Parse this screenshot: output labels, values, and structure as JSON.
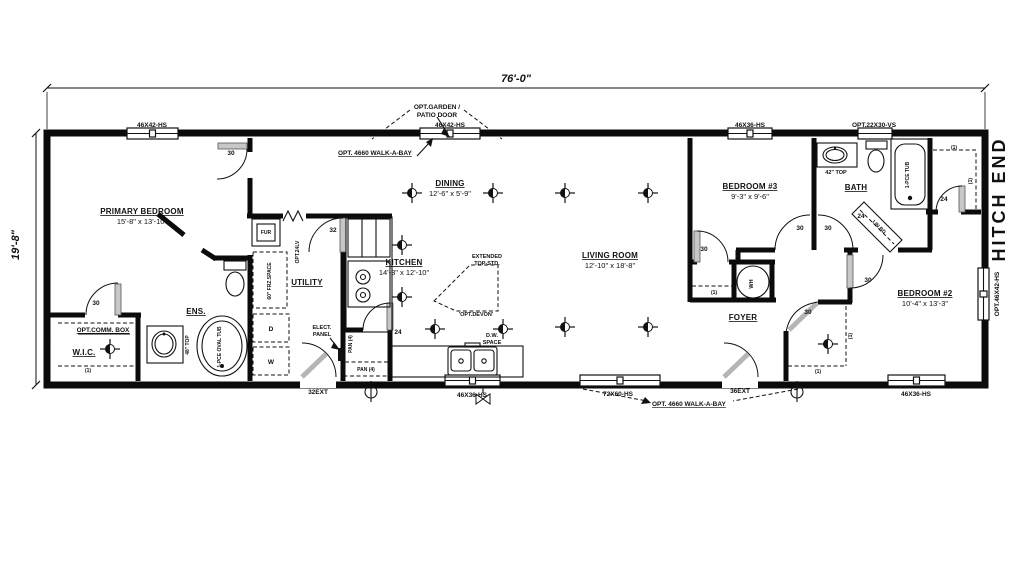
{
  "plan": {
    "hitch_end": "HITCH END"
  },
  "dimensions": {
    "overall_width": "76'-0\"",
    "overall_depth": "19'-8\""
  },
  "rooms": {
    "primary_bedroom": {
      "name": "PRIMARY BEDROOM",
      "size": "15'-8\" x 13'-10\""
    },
    "dining": {
      "name": "DINING",
      "size": "12'-6\" x 5'-9\""
    },
    "kitchen": {
      "name": "KITCHEN",
      "size": "14'-3\" x 12'-10\""
    },
    "living_room": {
      "name": "LIVING ROOM",
      "size": "12'-10\" x 18'-8\""
    },
    "bedroom_3": {
      "name": "BEDROOM #3",
      "size": "9'-3\" x 9'-6\""
    },
    "bedroom_2": {
      "name": "BEDROOM #2",
      "size": "10'-4\" x 13'-3\""
    },
    "bath": {
      "name": "BATH"
    },
    "utility": {
      "name": "UTILITY"
    },
    "foyer": {
      "name": "FOYER"
    },
    "ensuite": {
      "name": "ENS."
    },
    "walk_in_closet": {
      "name": "W.I.C."
    }
  },
  "windows": {
    "primary_top": "46X42-HS",
    "dining_top": "46X42-HS",
    "bedroom3_top": "46X36-HS",
    "bath_top": "OPT.22X30-VS",
    "kitchen_bottom": "46X36-HS",
    "living_bottom": "72X60-HS",
    "bedroom2_bottom": "46X36-HS",
    "bedroom2_side": "OPT.46X42-HS"
  },
  "doors": {
    "d30": "30",
    "d24": "24",
    "d32": "32",
    "utility_exterior": "32EXT",
    "foyer_exterior": "36EXT"
  },
  "notes": {
    "garden_line1": "OPT.GARDEN /",
    "garden_line2": "PATIO DOOR",
    "walkabay_top": "OPT. 4660 WALK-A-BAY",
    "walkabay_bottom": "OPT. 4660 WALK-A-BAY",
    "comm_box": "OPT.COMM. BOX",
    "devon": "'OPT.DEVON'",
    "extended_line1": "EXTENDED",
    "extended_line2": "TOP-STD.",
    "dw_line1": "D.W.",
    "dw_line2": "SPACE",
    "elect_line1": "ELECT.",
    "elect_line2": "PANEL"
  },
  "fixtures": {
    "pantry_shelves": "PAN (4)",
    "pantry_base": "PAN (4)",
    "freezer_space": "60\" FRZ.SPACE",
    "louver_door": "OPT.24LV",
    "ens_vanity_top": "48\" TOP",
    "bath_vanity_top": "42\" TOP",
    "oval_tub": "1-PCE OVAL TUB",
    "bath_tub": "1-PCE TUB",
    "linen": "LIN BD",
    "water_heater": "WH",
    "furnace": "FUR",
    "dryer": "D",
    "washer": "W"
  },
  "marks": {
    "shelf": "(1)"
  }
}
